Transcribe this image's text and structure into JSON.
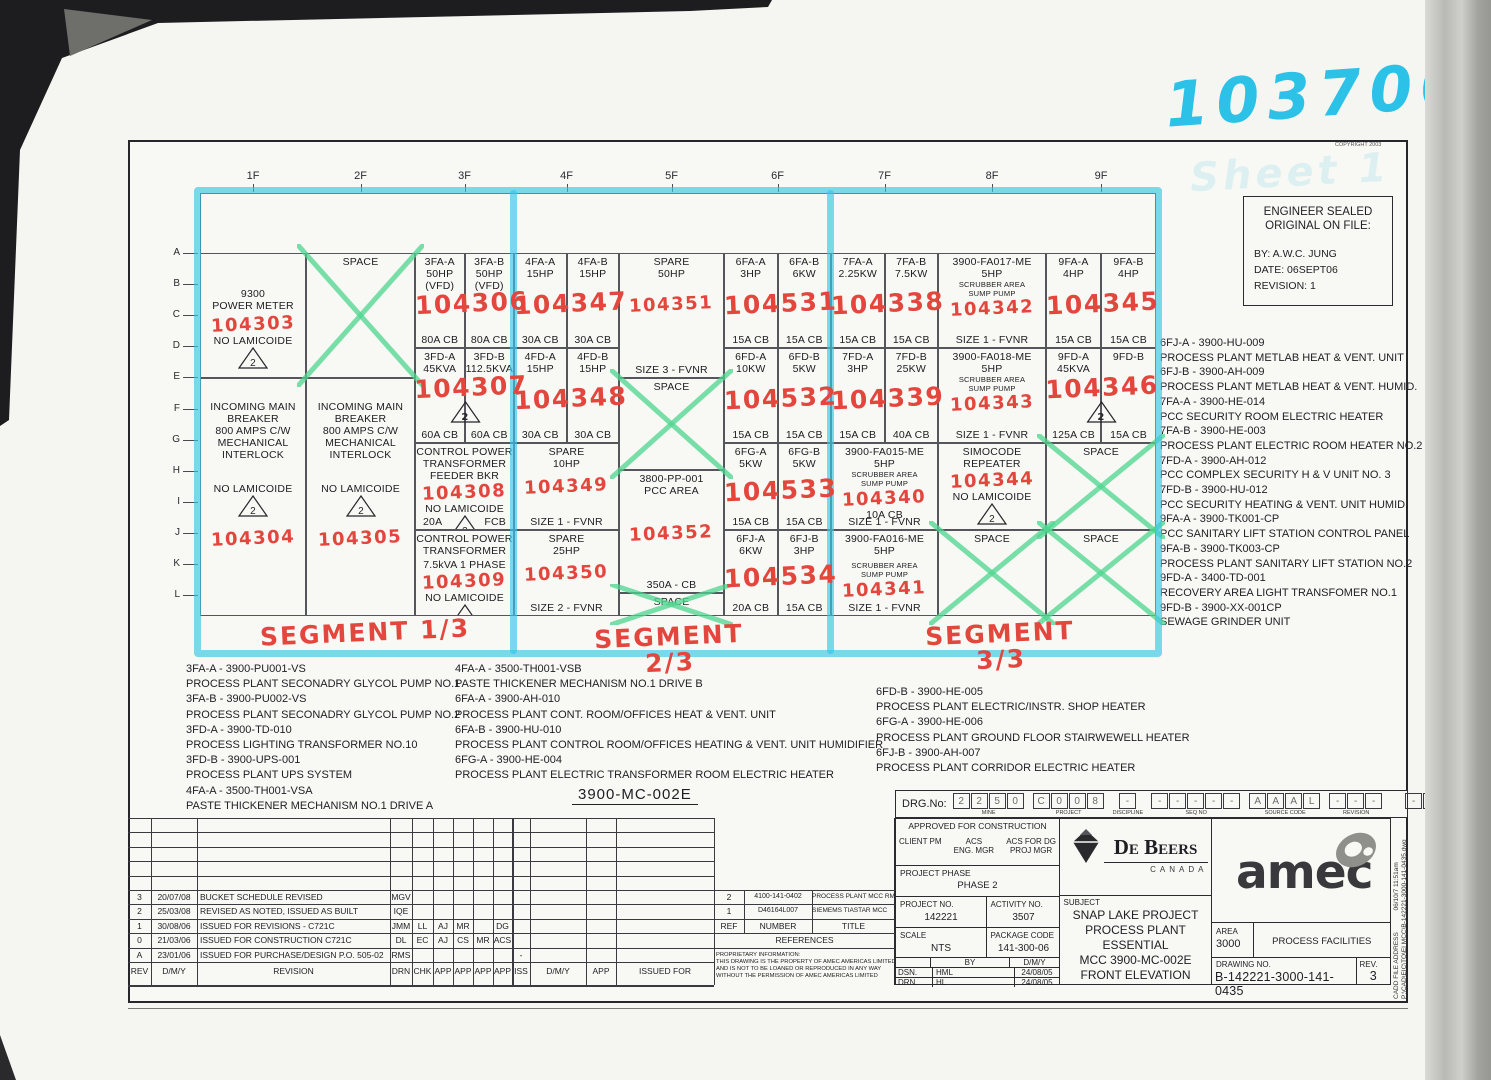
{
  "annotations": {
    "stamp_number": "103700",
    "ghost_text": "Sheet 1",
    "copyright": "COPYRIGHT 2003",
    "triangle_note": "2",
    "segment_labels": [
      "SEGMENT 1/3",
      "SEGMENT 2/3",
      "SEGMENT 3/3"
    ],
    "colors": {
      "marker_cyan": "#38c7e9",
      "marker_green": "#4dd68f",
      "hand_red": "#e2463d"
    }
  },
  "engineer_box": {
    "lines": [
      "ENGINEER SEALED",
      "ORIGINAL ON FILE:",
      "BY: A.W.C. JUNG",
      "DATE: 06SEPT06",
      "REVISION: 1"
    ]
  },
  "grid": {
    "column_headers": [
      "1F",
      "2F",
      "3F",
      "4F",
      "5F",
      "6F",
      "7F",
      "8F",
      "9F"
    ],
    "row_labels": [
      "A",
      "B",
      "C",
      "D",
      "E",
      "F",
      "G",
      "H",
      "I",
      "J",
      "K",
      "L"
    ],
    "cells": [
      {
        "col": "1F",
        "sub": "F",
        "sec": 0,
        "lines": [
          {
            "g": 32
          },
          "9300",
          "POWER METER",
          {
            "g": 2
          },
          {
            "r": "104303"
          },
          "NO LAMICOIDE",
          {
            "tri": 1
          }
        ]
      },
      {
        "col": "1F",
        "sub": "F",
        "sec": 1,
        "lines": [
          {
            "g": 20
          },
          "INCOMING MAIN",
          "BREAKER",
          "800 AMPS C/W",
          "MECHANICAL",
          "INTERLOCK",
          {
            "g": 22
          },
          "NO LAMICOIDE",
          {
            "tri": 1
          },
          {
            "g": 10
          },
          {
            "r": "104304"
          }
        ]
      },
      {
        "col": "2F",
        "sub": "F",
        "sec": 0,
        "x": 1,
        "lines": [
          "SPACE"
        ]
      },
      {
        "col": "2F",
        "sub": "F",
        "sec": 1,
        "lines": [
          {
            "g": 20
          },
          "INCOMING MAIN",
          "BREAKER",
          "800 AMPS C/W",
          "MECHANICAL",
          "INTERLOCK",
          {
            "g": 22
          },
          "NO LAMICOIDE",
          {
            "tri": 1
          },
          {
            "g": 10
          },
          {
            "r": "104305"
          }
        ]
      },
      {
        "col": "3F",
        "sub": "A",
        "sec": 0,
        "lines": [
          "3FA-A",
          "50HP",
          "(VFD)"
        ],
        "bottom": "80A CB"
      },
      {
        "col": "3F",
        "sub": "B",
        "sec": 0,
        "lines": [
          "3FA-B",
          "50HP",
          "(VFD)"
        ],
        "bottom": "80A CB"
      },
      {
        "col": "3F",
        "sub": "A",
        "sec": 1,
        "lines": [
          "3FD-A",
          "45KVA"
        ],
        "bottom": "60A CB"
      },
      {
        "col": "3F",
        "sub": "B",
        "sec": 1,
        "lines": [
          "3FD-B",
          "112.5KVA"
        ],
        "bottom": "60A CB"
      },
      {
        "col": "3F",
        "sub": "F",
        "sec": 2,
        "lines": [
          "CONTROL POWER",
          "TRANSFORMER",
          "FEEDER BKR",
          {
            "r": "104308"
          },
          "NO LAMICOIDE",
          {
            "tri": 1
          }
        ],
        "bottom2": [
          "20A",
          "FCB"
        ]
      },
      {
        "col": "3F",
        "sub": "F",
        "sec": 3,
        "lines": [
          "CONTROL POWER",
          "TRANSFORMER",
          {
            "g": 4
          },
          "7.5kVA 1 PHASE",
          {
            "r": "104309"
          },
          "NO LAMICOIDE",
          {
            "tri": 1
          }
        ]
      },
      {
        "col": "4F",
        "sub": "A",
        "sec": 0,
        "lines": [
          "4FA-A",
          "15HP"
        ],
        "bottom": "30A CB"
      },
      {
        "col": "4F",
        "sub": "B",
        "sec": 0,
        "lines": [
          "4FA-B",
          "15HP"
        ],
        "bottom": "30A CB"
      },
      {
        "col": "4F",
        "sub": "A",
        "sec": 1,
        "lines": [
          "4FD-A",
          "15HP"
        ],
        "bottom": "30A CB"
      },
      {
        "col": "4F",
        "sub": "B",
        "sec": 1,
        "lines": [
          "4FD-B",
          "15HP"
        ],
        "bottom": "30A CB"
      },
      {
        "col": "4F",
        "sub": "F",
        "sec": 2,
        "lines": [
          "SPARE",
          "10HP",
          {
            "g": 6
          },
          {
            "r": "104349"
          }
        ],
        "bottom": "SIZE 1 - FVNR"
      },
      {
        "col": "4F",
        "sub": "F",
        "sec": 3,
        "lines": [
          "SPARE",
          "25HP",
          {
            "g": 6
          },
          {
            "r": "104350"
          }
        ],
        "bottom": "SIZE 2 - FVNR"
      },
      {
        "col": "5F",
        "sub": "F",
        "sec": 0,
        "lines": [
          "SPARE",
          "50HP",
          {
            "g": 14
          },
          {
            "r": "104351"
          }
        ],
        "bottom": "SIZE 3 - FVNR"
      },
      {
        "col": "5F",
        "sub": "F",
        "sec": 1,
        "x": 1,
        "lines": [
          "SPACE"
        ]
      },
      {
        "col": "5F",
        "sub": "F",
        "sec": 2,
        "lines": [
          "3800-PP-001",
          "PCC AREA",
          {
            "g": 26
          },
          {
            "r": "104352"
          }
        ],
        "bottom": "350A - CB"
      },
      {
        "col": "5F",
        "sub": "F",
        "sec": 3,
        "x": 1,
        "lines": [
          "SPACE"
        ]
      },
      {
        "col": "6F",
        "sub": "A",
        "sec": 0,
        "lines": [
          "6FA-A",
          "3HP"
        ],
        "bottom": "15A CB"
      },
      {
        "col": "6F",
        "sub": "B",
        "sec": 0,
        "lines": [
          "6FA-B",
          "6KW"
        ],
        "bottom": "15A CB"
      },
      {
        "col": "6F",
        "sub": "A",
        "sec": 1,
        "lines": [
          "6FD-A",
          "10KW"
        ],
        "bottom": "15A CB"
      },
      {
        "col": "6F",
        "sub": "B",
        "sec": 1,
        "lines": [
          "6FD-B",
          "5KW"
        ],
        "bottom": "15A CB"
      },
      {
        "col": "6F",
        "sub": "A",
        "sec": 2,
        "lines": [
          "6FG-A",
          "5KW"
        ],
        "bottom": "15A CB"
      },
      {
        "col": "6F",
        "sub": "B",
        "sec": 2,
        "lines": [
          "6FG-B",
          "5KW"
        ],
        "bottom": "15A CB"
      },
      {
        "col": "6F",
        "sub": "A",
        "sec": 3,
        "lines": [
          "6FJ-A",
          "6KW"
        ],
        "bottom": "20A CB"
      },
      {
        "col": "6F",
        "sub": "B",
        "sec": 3,
        "lines": [
          "6FJ-B",
          "3HP"
        ],
        "bottom": "15A CB"
      },
      {
        "col": "7F",
        "sub": "A",
        "sec": 0,
        "lines": [
          "7FA-A",
          "2.25KW"
        ],
        "bottom": "15A CB"
      },
      {
        "col": "7F",
        "sub": "B",
        "sec": 0,
        "lines": [
          "7FA-B",
          "7.5KW"
        ],
        "bottom": "15A CB"
      },
      {
        "col": "7F",
        "sub": "A",
        "sec": 1,
        "lines": [
          "7FD-A",
          "3HP"
        ],
        "bottom": "15A CB"
      },
      {
        "col": "7F",
        "sub": "B",
        "sec": 1,
        "lines": [
          "7FD-B",
          "25KW"
        ],
        "bottom": "40A CB"
      },
      {
        "col": "7F",
        "sub": "F",
        "sec": 2,
        "lines": [
          "3900-FA015-ME",
          "5HP",
          {
            "s": "SCRUBBER AREA"
          },
          {
            "s": "SUMP PUMP"
          },
          {
            "r": "104340"
          },
          "10A CB"
        ],
        "bottom": "SIZE 1 - FVNR"
      },
      {
        "col": "7F",
        "sub": "F",
        "sec": 3,
        "lines": [
          "3900-FA016-ME",
          "5HP",
          {
            "g": 4
          },
          {
            "s": "SCRUBBER AREA"
          },
          {
            "s": "SUMP PUMP"
          },
          {
            "r": "104341"
          }
        ],
        "bottom": "SIZE 1 - FVNR"
      },
      {
        "col": "8F",
        "sub": "F",
        "sec": 0,
        "lines": [
          "3900-FA017-ME",
          "5HP",
          {
            "s": "SCRUBBER AREA"
          },
          {
            "s": "SUMP PUMP"
          },
          {
            "r": "104342"
          }
        ],
        "bottom": "SIZE 1 - FVNR"
      },
      {
        "col": "8F",
        "sub": "F",
        "sec": 1,
        "lines": [
          "3900-FA018-ME",
          "5HP",
          {
            "s": "SCRUBBER AREA"
          },
          {
            "s": "SUMP PUMP"
          },
          {
            "r": "104343"
          }
        ],
        "bottom": "SIZE 1 - FVNR"
      },
      {
        "col": "8F",
        "sub": "F",
        "sec": 2,
        "lines": [
          "SIMOCODE",
          "REPEATER",
          {
            "r": "104344"
          },
          "NO LAMICOIDE",
          {
            "tri": 1
          }
        ]
      },
      {
        "col": "8F",
        "sub": "F",
        "sec": 3,
        "x": 1,
        "lines": [
          "SPACE"
        ]
      },
      {
        "col": "9F",
        "sub": "A",
        "sec": 0,
        "lines": [
          "9FA-A",
          "4HP"
        ],
        "bottom": "15A CB"
      },
      {
        "col": "9F",
        "sub": "B",
        "sec": 0,
        "lines": [
          "9FA-B",
          "4HP"
        ],
        "bottom": "15A CB"
      },
      {
        "col": "9F",
        "sub": "A",
        "sec": 1,
        "lines": [
          "9FD-A",
          "45KVA"
        ],
        "bottom": "125A CB"
      },
      {
        "col": "9F",
        "sub": "B",
        "sec": 1,
        "lines": [
          "9FD-B"
        ],
        "bottom": "15A CB"
      },
      {
        "col": "9F",
        "sub": "F",
        "sec": 2,
        "x": 1,
        "lines": [
          "SPACE"
        ]
      },
      {
        "col": "9F",
        "sub": "F",
        "sec": 3,
        "x": 1,
        "lines": [
          "SPACE"
        ]
      }
    ],
    "red_overlays": [
      {
        "col": "3F",
        "sec": 0,
        "text": "104306"
      },
      {
        "col": "3F",
        "sec": 1,
        "text": "104307",
        "tri": 1
      },
      {
        "col": "4F",
        "sec": 0,
        "text": "104347"
      },
      {
        "col": "4F",
        "sec": 1,
        "text": "104348"
      },
      {
        "col": "6F",
        "sec": 0,
        "text": "104531"
      },
      {
        "col": "6F",
        "sec": 1,
        "text": "104532"
      },
      {
        "col": "6F",
        "sec": 2,
        "text": "104533"
      },
      {
        "col": "6F",
        "sec": 3,
        "text": "104534"
      },
      {
        "col": "7F",
        "sec": 0,
        "text": "104338"
      },
      {
        "col": "7F",
        "sec": 1,
        "text": "104339"
      },
      {
        "col": "9F",
        "sec": 0,
        "text": "104345"
      },
      {
        "col": "9F",
        "sec": 1,
        "text": "104346",
        "tri": 1
      }
    ]
  },
  "equipment_lists": {
    "right": [
      {
        "tag": "6FJ-A - 3900-HU-009",
        "desc": "PROCESS PLANT METLAB HEAT & VENT. UNIT"
      },
      {
        "tag": "6FJ-B - 3900-AH-009",
        "desc": "PROCESS PLANT METLAB HEAT & VENT. HUMID."
      },
      {
        "tag": "7FA-A - 3900-HE-014",
        "desc": "PCC SECURITY ROOM ELECTRIC HEATER"
      },
      {
        "tag": "7FA-B - 3900-HE-003",
        "desc": "PROCESS PLANT ELECTRIC ROOM HEATER NO.2"
      },
      {
        "tag": "7FD-A - 3900-AH-012",
        "desc": "PCC COMPLEX SECURITY H & V UNIT NO. 3"
      },
      {
        "tag": "7FD-B - 3900-HU-012",
        "desc": "PCC SECURITY HEATING & VENT. UNIT HUMID."
      },
      {
        "tag": "9FA-A - 3900-TK001-CP",
        "desc": "PCC SANITARY LIFT STATION CONTROL PANEL"
      },
      {
        "tag": "9FA-B - 3900-TK003-CP",
        "desc": "PROCESS PLANT SANITARY LIFT STATION NO.2"
      },
      {
        "tag": "9FD-A - 3400-TD-001",
        "desc": "RECOVERY AREA LIGHT TRANSFOMER NO.1"
      },
      {
        "tag": "9FD-B - 3900-XX-001CP",
        "desc": "SEWAGE GRINDER UNIT"
      }
    ],
    "bottom_left": [
      {
        "tag": "3FA-A - 3900-PU001-VS",
        "desc": "PROCESS PLANT SECONADRY GLYCOL PUMP NO.1"
      },
      {
        "tag": "3FA-B - 3900-PU002-VS",
        "desc": "PROCESS PLANT SECONADRY GLYCOL PUMP NO.2"
      },
      {
        "tag": "3FD-A - 3900-TD-010",
        "desc": "PROCESS LIGHTING TRANSFORMER NO.10"
      },
      {
        "tag": "3FD-B - 3900-UPS-001",
        "desc": "PROCESS PLANT UPS SYSTEM"
      },
      {
        "tag": "4FA-A - 3500-TH001-VSA",
        "desc": "PASTE THICKENER MECHANISM NO.1 DRIVE A"
      }
    ],
    "bottom_middle": [
      {
        "tag": "4FA-A - 3500-TH001-VSB",
        "desc": "PASTE THICKENER MECHANISM NO.1 DRIVE B"
      },
      {
        "tag": "6FA-A - 3900-AH-010",
        "desc": "PROCESS PLANT CONT. ROOM/OFFICES HEAT & VENT. UNIT"
      },
      {
        "tag": "6FA-B - 3900-HU-010",
        "desc": "PROCESS PLANT CONTROL ROOM/OFFICES HEATING & VENT. UNIT HUMIDIFIER"
      },
      {
        "tag": "6FG-A - 3900-HE-004",
        "desc": "PROCESS PLANT ELECTRIC TRANSFORMER ROOM ELECTRIC HEATER"
      }
    ],
    "bottom_right": [
      {
        "tag": "6FD-B - 3900-HE-005",
        "desc": "PROCESS PLANT ELECTRIC/INSTR. SHOP HEATER"
      },
      {
        "tag": "6FG-A - 3900-HE-006",
        "desc": "PROCESS PLANT GROUND FLOOR STAIRWEWELL HEATER"
      },
      {
        "tag": "6FJ-B - 3900-AH-007",
        "desc": "PROCESS PLANT CORRIDOR ELECTRIC HEATER"
      }
    ]
  },
  "footer": {
    "drawing_title": "3900-MC-002E"
  },
  "drg": {
    "label": "DRG.No:",
    "groups": [
      {
        "name": "MINE",
        "boxes": [
          "2",
          "2",
          "5",
          "0"
        ]
      },
      {
        "name": "PROJECT",
        "boxes": [
          "C",
          "0",
          "0",
          "8"
        ]
      },
      {
        "name": "DISCIPLINE",
        "boxes": [
          "-"
        ]
      },
      {
        "name": "SEQ NO",
        "boxes": [
          "-",
          "-",
          "-",
          "-",
          "-"
        ]
      },
      {
        "name": "SOURCE CODE",
        "boxes": [
          "A",
          "A",
          "A",
          "L"
        ]
      },
      {
        "name": "REVISION",
        "boxes": [
          "-",
          "-",
          "-"
        ]
      },
      {
        "name": "TYPE",
        "boxes": [
          "-",
          "-",
          "-"
        ]
      }
    ]
  },
  "revision_table": {
    "headers": [
      "REV",
      "D/M/Y",
      "REVISION"
    ],
    "sign_headers": [
      "DRN",
      "CHK",
      "APP",
      "APP",
      "APP",
      "APP"
    ],
    "rows": [
      {
        "rev": "3",
        "date": "20/07/08",
        "desc": "BUCKET SCHEDULE REVISED",
        "sign": [
          "MGV",
          "",
          "",
          "",
          "",
          ""
        ]
      },
      {
        "rev": "2",
        "date": "25/03/08",
        "desc": "REVISED AS NOTED, ISSUED AS BUILT",
        "sign": [
          "IQE",
          "",
          "",
          "",
          "",
          ""
        ]
      },
      {
        "rev": "1",
        "date": "30/08/06",
        "desc": "ISSUED FOR REVISIONS - C721C",
        "sign": [
          "JMM",
          "LL",
          "AJ",
          "MR",
          "",
          "DG"
        ]
      },
      {
        "rev": "0",
        "date": "21/03/06",
        "desc": "ISSUED FOR CONSTRUCTION C721C",
        "sign": [
          "DL",
          "EC",
          "AJ",
          "CS",
          "MR",
          "ACS"
        ]
      },
      {
        "rev": "A",
        "date": "23/01/06",
        "desc": "ISSUED FOR PURCHASE/DESIGN P.O. 505-02",
        "sign": [
          "RMS",
          "",
          "",
          "",
          "",
          ""
        ]
      }
    ],
    "iss_headers": [
      "ISS",
      "D/M/Y",
      "APP",
      "ISSUED FOR"
    ],
    "iss_mark": "-"
  },
  "references": {
    "caption": "REFERENCES",
    "headers": [
      "REF",
      "NUMBER",
      "TITLE"
    ],
    "rows": [
      {
        "ref": "2",
        "number": "4100-141-0402",
        "title": "PROCESS PLANT MCC RM EQUIP. I/O"
      },
      {
        "ref": "1",
        "number": "D46164L007",
        "title": "SIEMEMS TIASTAR MCC"
      }
    ]
  },
  "proprietary": {
    "lines": [
      "PROPRIETARY INFORMATION:",
      "THIS DRAWING IS THE PROPERTY OF AMEC AMERICAS LIMITED.",
      "AND IS NOT TO BE LOANED OR REPRODUCED IN ANY WAY",
      "WITHOUT THE PERMISSION OF AMEC AMERICAS LIMITED"
    ]
  },
  "titleblock": {
    "approved": {
      "line1": "APPROVED FOR CONSTRUCTION",
      "acs": "ACS",
      "acs_for": "ACS FOR DG",
      "cols": [
        "CLIENT PM",
        "ENG. MGR",
        "PROJ MGR"
      ]
    },
    "phase": {
      "label": "PROJECT PHASE",
      "value": "PHASE 2"
    },
    "project_no": {
      "label": "PROJECT NO.",
      "value": "142221"
    },
    "activity_no": {
      "label": "ACTIVITY NO.",
      "value": "3507"
    },
    "scale": {
      "label": "SCALE",
      "value": "NTS"
    },
    "package_code": {
      "label": "PACKAGE CODE",
      "value": "141-300-06"
    },
    "sign": {
      "by": "BY",
      "dmy": "D/M/Y",
      "rows": [
        [
          "DSN.",
          "HML",
          "24/08/05"
        ],
        [
          "DRN.",
          "HL",
          "24/08/05"
        ]
      ]
    },
    "subject": {
      "label": "SUBJECT",
      "lines": [
        "SNAP LAKE PROJECT",
        "PROCESS PLANT",
        "ESSENTIAL",
        "MCC 3900-MC-002E",
        "FRONT ELEVATION"
      ]
    },
    "debeers": {
      "name": "De Beers",
      "country": "CANADA"
    },
    "amec": "amec",
    "area": {
      "label": "AREA",
      "value": "3000"
    },
    "facilities": "PROCESS FACILITIES",
    "drawing_no": {
      "label": "DRAWING NO.",
      "value": "B-142221-3000-141-0435"
    },
    "rev": {
      "label": "REV.",
      "value": "3"
    },
    "cadd": {
      "label": "CADD FILE ADDRESS",
      "datetime": "06/10/7  11:51am",
      "path": "P:\\CAD\\EIC\\TO\\EI MCC\\B-142221-3000-141-0435.dwg"
    }
  }
}
